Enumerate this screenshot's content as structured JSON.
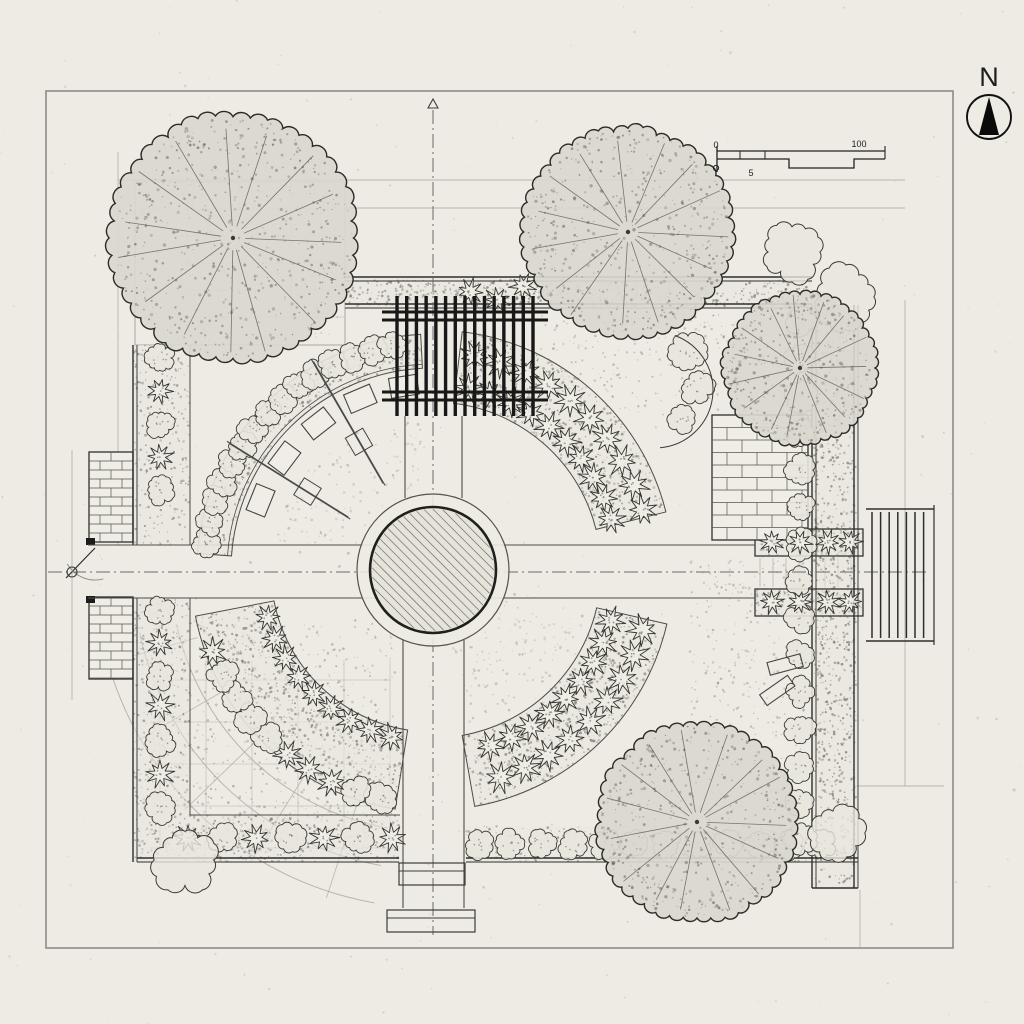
{
  "title": "Garden landscape plan, top view",
  "colors": {
    "paper": "#edebe4",
    "ink": "#1d1d1d",
    "line": "#4a4a46",
    "mid": "#6f6d67",
    "faint": "#a9a79f",
    "canopy": "#d9d7ce",
    "bed_fill": "#e8e6dd",
    "stipple": "#77756e",
    "pergola": "#181818"
  },
  "compass": {
    "label": "N"
  },
  "scale_bar": {
    "labels": [
      "0",
      "5",
      "100"
    ]
  },
  "plan": {
    "trees": [
      {
        "name": "tree-northwest",
        "cx": 233,
        "cy": 238,
        "r": 122
      },
      {
        "name": "tree-north",
        "cx": 628,
        "cy": 232,
        "r": 103
      },
      {
        "name": "tree-east",
        "cx": 800,
        "cy": 368,
        "r": 75
      },
      {
        "name": "tree-south",
        "cx": 697,
        "cy": 822,
        "r": 98
      }
    ],
    "pond": {
      "cx": 433,
      "cy": 570,
      "r_outer": 76,
      "r_inner": 63
    },
    "pergola": {
      "x": 385,
      "y": 296,
      "width": 160,
      "height": 120,
      "slats": 15
    },
    "axes": {
      "vertical_x": 433,
      "horizontal_y": 572
    },
    "frame": {
      "x": 46,
      "y": 91,
      "width": 907,
      "height": 857
    }
  }
}
